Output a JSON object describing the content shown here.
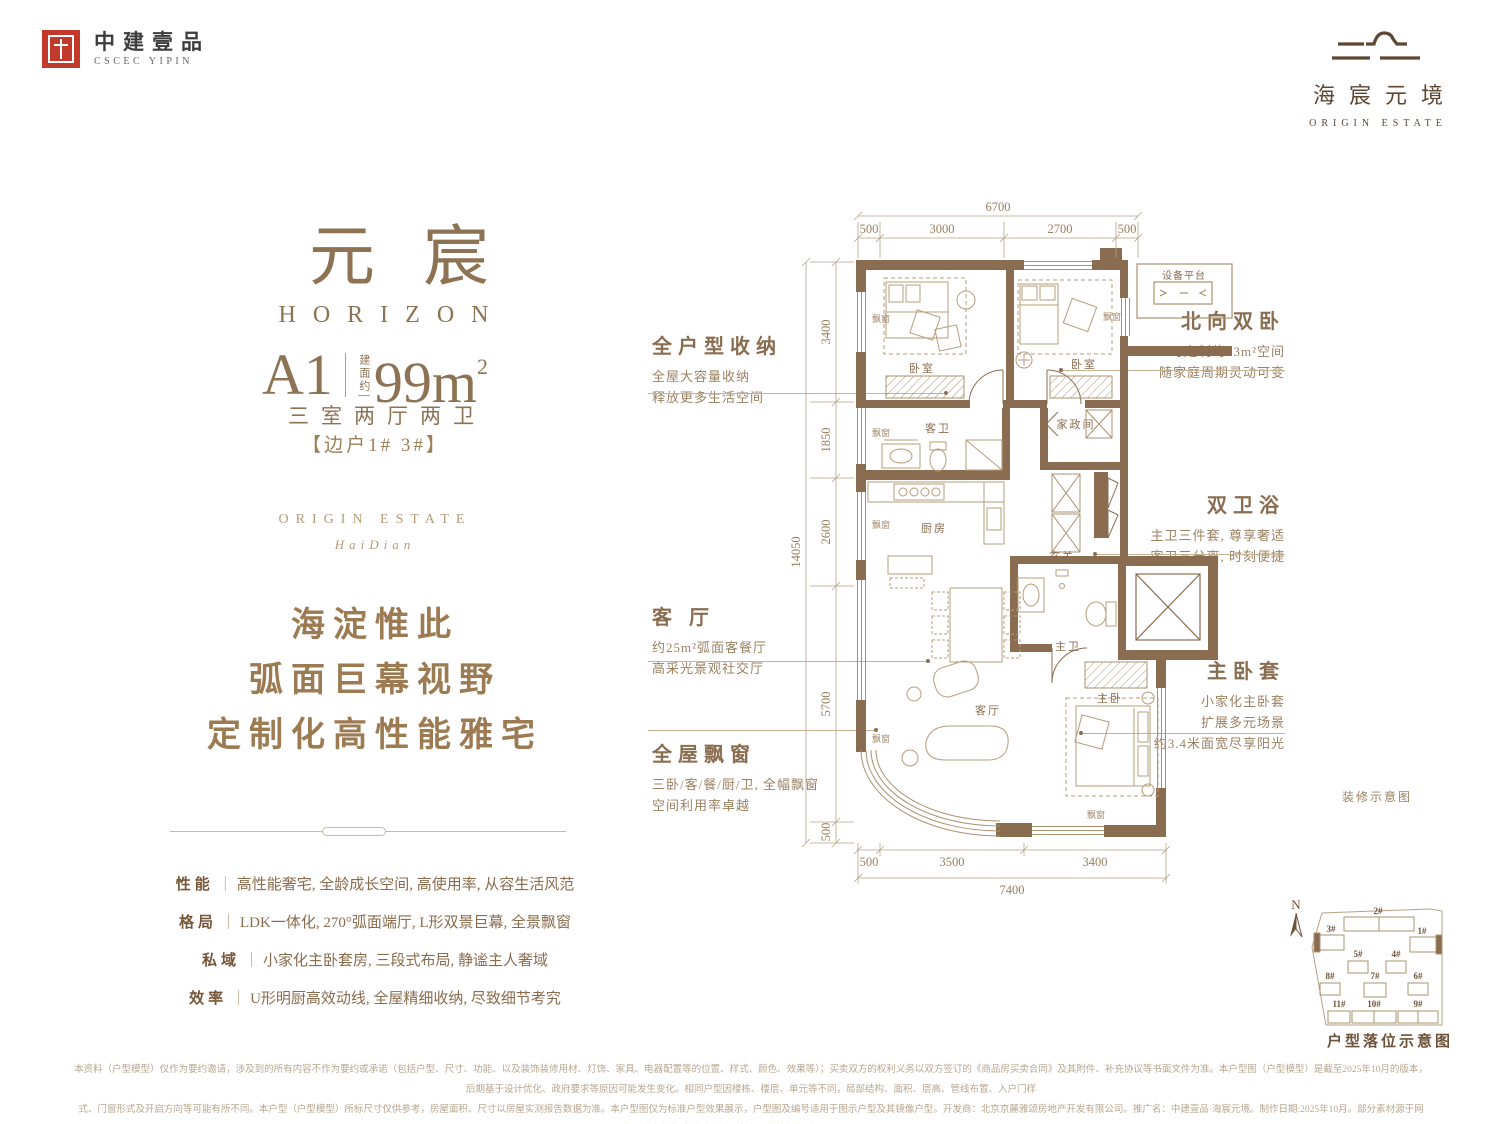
{
  "header": {
    "cscec_logo_cn": "中建壹品",
    "cscec_logo_en": "CSCEC YIPIN",
    "estate_logo_cn": "海宸元境",
    "estate_logo_en": "ORIGIN ESTATE"
  },
  "hero": {
    "title_cn": "元宸",
    "title_en": "HORIZON",
    "unit_code": "A1",
    "area_prefix": "建面约",
    "area_value": "99m",
    "area_sup": "2",
    "layout": "三室两厅两卫",
    "position_tag": "【边户1#  3#】",
    "estate_en": "ORIGIN  ESTATE",
    "estate_en_sub": "HaiDian",
    "slogan1": "海淀惟此",
    "slogan2": "弧面巨幕视野",
    "slogan3": "定制化高性能雅宅"
  },
  "misc": {
    "divider": "｜"
  },
  "features": [
    {
      "label": "性能",
      "text": "高性能奢宅, 全龄成长空间, 高使用率, 从容生活风范"
    },
    {
      "label": "格局",
      "text": "LDK一体化, 270°弧面端厅, L形双景巨幕, 全景飘窗"
    },
    {
      "label": "私域",
      "text": "小家化主卧套房, 三段式布局, 静谧主人奢域"
    },
    {
      "label": "效率",
      "text": "U形明厨高效动线, 全屋精细收纳, 尽致细节考究"
    }
  ],
  "callouts": {
    "storage": {
      "title": "全户型收纳",
      "line1": "全屋大容量收纳",
      "line2": "释放更多生活空间"
    },
    "living": {
      "title": "客 厅",
      "line1": "约25m²弧面客餐厅",
      "line2": "高采光景观社交厅"
    },
    "baywindow": {
      "title": "全屋飘窗",
      "line1": "三卧/客/餐/厨/卫, 全幅飘窗",
      "line2": "空间利用率卓越"
    },
    "north_bedrooms": {
      "title": "北向双卧",
      "line1": "可定制约23m²空间",
      "line2": "随家庭周期灵动可变"
    },
    "bathrooms": {
      "title": "双卫浴",
      "line1": "主卫三件套, 尊享奢适",
      "line2": "客卫三分离, 时刻便捷"
    },
    "master_suite": {
      "title": "主卧套",
      "line1": "小家化主卧套",
      "line2": "扩展多元场景",
      "line3": "约3.4米面宽尽享阳光"
    }
  },
  "plan": {
    "labels": {
      "bedroom": "卧室",
      "bay_window": "飘窗",
      "equipment_platform": "设备平台",
      "laundry": "家政间",
      "guest_bath": "客卫",
      "kitchen": "厨房",
      "foyer": "玄关",
      "master_bath": "主卫",
      "master_bedroom": "主卧",
      "living_room": "客厅"
    },
    "dims_top": {
      "total": "6700",
      "segments": [
        "500",
        "3000",
        "2700",
        "500"
      ]
    },
    "dims_left": {
      "total": "14050",
      "segments": [
        "3400",
        "1850",
        "2600",
        "5700",
        "500"
      ]
    },
    "dims_bottom": {
      "total": "7400",
      "segments": [
        "500",
        "3500",
        "3400"
      ]
    },
    "note": "装修示意图"
  },
  "siteplan": {
    "compass": "N",
    "caption": "户型落位示意图",
    "buildings": [
      "2#",
      "3#",
      "1#",
      "5#",
      "4#",
      "8#",
      "7#",
      "6#",
      "11#",
      "10#",
      "9#"
    ]
  },
  "disclaimer": {
    "line1": "本资料（户型模型）仅作为要约邀请，涉及到的所有内容不作为要约或承诺（包括户型、尺寸、功能、以及装饰装修用材、灯饰、家具、电器配置等的位置、样式、颜色、效果等）；买卖双方的权利义务以双方签订的《商品房买卖合同》及其附件、补充协议等书面文件为准。本户型图（户型模型）是截至2025年10月的版本，后期基于设计优化、政府要求等原因可能发生变化。相同户型因楼栋、楼层、单元等不同，局部结构、面积、层高、管线布置、入户门样",
    "line2": "式、门窗形式及开启方向等可能有所不同。本户型（户型模型）所标尺寸仅供参考，房屋面积、尺寸以房屋实测报告数据为准。本户型图仅为标准户型效果展示，户型图及编号适用于图示户型及其镜像户型。开发商：北京京麓雅颂房地产开发有限公司。推广名：中建壹品·海宸元境。制作日期:2025年10月。部分素材源于网络，如有侵权请联系删除。客户服务监督电话:400-698-6688。"
  }
}
